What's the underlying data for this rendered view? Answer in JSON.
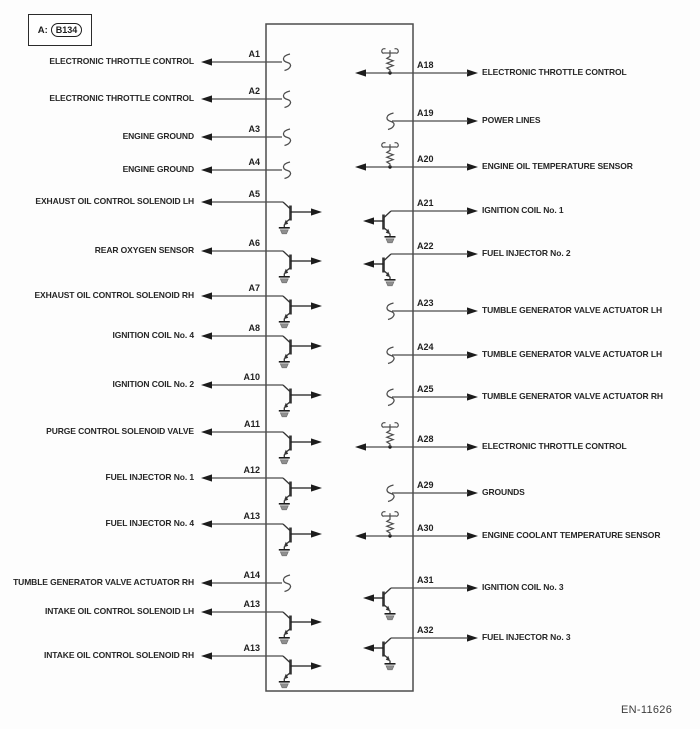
{
  "header": {
    "prefix": "A:",
    "connector_id": "B134"
  },
  "footer": {
    "code": "EN-11626"
  },
  "colors": {
    "wire": "#4d4d4d",
    "ink": "#1c1c1c",
    "symbol": "#333333",
    "text": "#262626",
    "ground_fill": "#8f8f8f"
  },
  "left_pins": [
    {
      "pin": "A1",
      "label": "ELECTRONIC THROTTLE CONTROL",
      "symbol": "break"
    },
    {
      "pin": "A2",
      "label": "ELECTRONIC THROTTLE CONTROL",
      "symbol": "break"
    },
    {
      "pin": "A3",
      "label": "ENGINE GROUND",
      "symbol": "break"
    },
    {
      "pin": "A4",
      "label": "ENGINE GROUND",
      "symbol": "break"
    },
    {
      "pin": "A5",
      "label": "EXHAUST OIL CONTROL SOLENOID LH",
      "symbol": "driver-transistor"
    },
    {
      "pin": "A6",
      "label": "REAR OXYGEN SENSOR",
      "symbol": "driver-transistor"
    },
    {
      "pin": "A7",
      "label": "EXHAUST OIL CONTROL SOLENOID RH",
      "symbol": "driver-transistor"
    },
    {
      "pin": "A8",
      "label": "IGNITION COIL No. 4",
      "symbol": "driver-transistor"
    },
    {
      "pin": "A10",
      "label": "IGNITION COIL No. 2",
      "symbol": "driver-transistor"
    },
    {
      "pin": "A11",
      "label": "PURGE CONTROL SOLENOID VALVE",
      "symbol": "driver-transistor"
    },
    {
      "pin": "A12",
      "label": "FUEL INJECTOR No. 1",
      "symbol": "driver-transistor"
    },
    {
      "pin": "A13",
      "label": "FUEL INJECTOR No. 4",
      "symbol": "driver-transistor"
    },
    {
      "pin": "A14",
      "label": "TUMBLE GENERATOR VALVE ACTUATOR RH",
      "symbol": "break"
    },
    {
      "pin": "A13",
      "label": "INTAKE OIL CONTROL SOLENOID LH",
      "symbol": "driver-transistor"
    },
    {
      "pin": "A13",
      "label": "INTAKE OIL CONTROL SOLENOID RH",
      "symbol": "driver-transistor"
    }
  ],
  "right_pins": [
    {
      "pin": "A18",
      "label": "ELECTRONIC THROTTLE CONTROL",
      "symbol": "pullup-resistor"
    },
    {
      "pin": "A19",
      "label": "POWER LINES",
      "symbol": "break"
    },
    {
      "pin": "A20",
      "label": "ENGINE OIL TEMPERATURE SENSOR",
      "symbol": "pullup-resistor"
    },
    {
      "pin": "A21",
      "label": "IGNITION COIL No. 1",
      "symbol": "driver-transistor"
    },
    {
      "pin": "A22",
      "label": "FUEL INJECTOR No. 2",
      "symbol": "driver-transistor"
    },
    {
      "pin": "A23",
      "label": "TUMBLE GENERATOR VALVE ACTUATOR LH",
      "symbol": "break"
    },
    {
      "pin": "A24",
      "label": "TUMBLE GENERATOR VALVE ACTUATOR LH",
      "symbol": "break"
    },
    {
      "pin": "A25",
      "label": "TUMBLE GENERATOR VALVE ACTUATOR RH",
      "symbol": "break"
    },
    {
      "pin": "A28",
      "label": "ELECTRONIC THROTTLE CONTROL",
      "symbol": "pullup-resistor"
    },
    {
      "pin": "A29",
      "label": "GROUNDS",
      "symbol": "break"
    },
    {
      "pin": "A30",
      "label": "ENGINE COOLANT TEMPERATURE SENSOR",
      "symbol": "pullup-resistor"
    },
    {
      "pin": "A31",
      "label": "IGNITION COIL No. 3",
      "symbol": "driver-transistor"
    },
    {
      "pin": "A32",
      "label": "FUEL INJECTOR No. 3",
      "symbol": "driver-transistor"
    }
  ]
}
